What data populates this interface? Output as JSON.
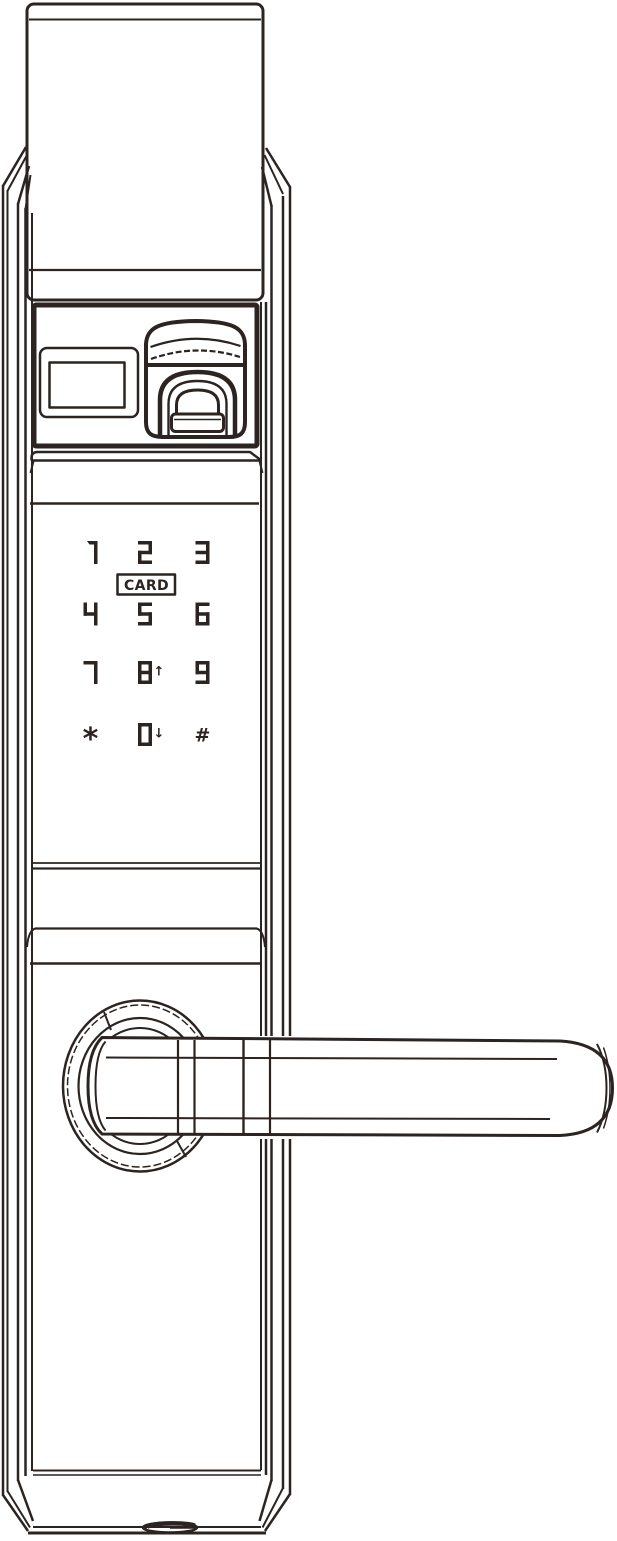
{
  "colors": {
    "line": "#2b2421",
    "background": "#ffffff"
  },
  "keypad": {
    "card_label": "CARD",
    "keys": [
      {
        "label": "1",
        "type": "digit",
        "col": 0,
        "row": 0
      },
      {
        "label": "2",
        "type": "digit",
        "col": 1,
        "row": 0
      },
      {
        "label": "3",
        "type": "digit",
        "col": 2,
        "row": 0
      },
      {
        "label": "4",
        "type": "digit",
        "col": 0,
        "row": 1
      },
      {
        "label": "5",
        "type": "digit",
        "col": 1,
        "row": 1
      },
      {
        "label": "6",
        "type": "digit",
        "col": 2,
        "row": 1
      },
      {
        "label": "7",
        "type": "digit",
        "col": 0,
        "row": 2
      },
      {
        "label": "8",
        "type": "digit",
        "col": 1,
        "row": 2,
        "suffix": "↑"
      },
      {
        "label": "9",
        "type": "digit",
        "col": 2,
        "row": 2
      },
      {
        "label": "*",
        "type": "symbol",
        "col": 0,
        "row": 3
      },
      {
        "label": "0",
        "type": "digit",
        "col": 1,
        "row": 3,
        "suffix": "↓"
      },
      {
        "label": "#",
        "type": "symbol",
        "col": 2,
        "row": 3
      }
    ]
  }
}
